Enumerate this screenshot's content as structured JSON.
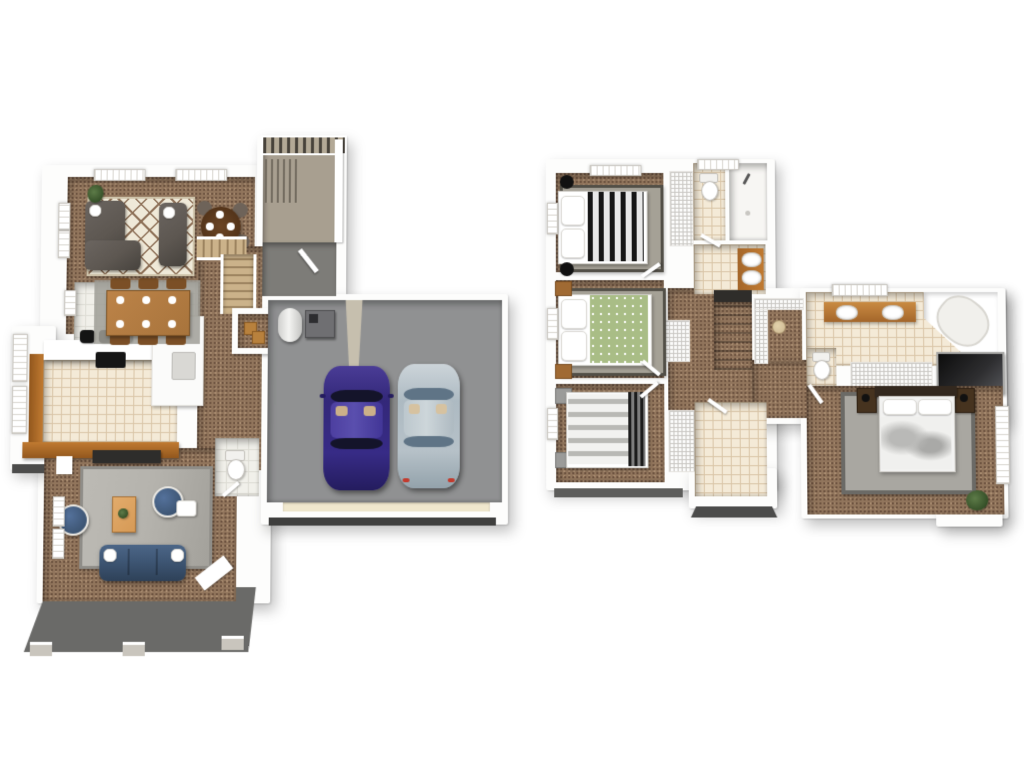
{
  "scene": {
    "type": "3d-floor-plan-rendering",
    "description": "Top-down 3D dollhouse floor plan of a two-story home, first floor on the left and second floor on the right, white background, no text labels",
    "levels_count": 2
  },
  "palette": {
    "wall": "#fdfdfc",
    "wall-shade": "#d7d4cf",
    "carpet-base": "#91755c",
    "carpet-dark": "#6d5340",
    "carpet-light": "#a98c70",
    "tile-cream": "#f4ead7",
    "tile-cream-line": "#d9c5a7",
    "tile-white": "#f1f0ea",
    "tile-white-line": "#dddcd4",
    "garage-floor": "#909192",
    "patio": "#6a6a68",
    "porch": "#7d7c78",
    "deck": "#a89f90",
    "deck-slat": "#47423a",
    "rug-cream": "#efe9d8",
    "rug-lattice": "#8d7057",
    "rug-gray": "#b5b3ad",
    "rug-gray-border": "#8f8d88",
    "rug-stone": "#a5a196",
    "rug-stone-border": "#524f47",
    "sofa-gray": "#5d5751",
    "navy": "#3e5674",
    "wood": "#c07a31",
    "wood-light": "#d69a56",
    "table-wood": "#a8743c",
    "stair-wood": "#cbb28a",
    "car-purple": "#372b86",
    "car-silver": "#b6c1c8",
    "bed-green": "#a9bd86",
    "headboard-dark": "#33281e",
    "hatch-line": "#c9c7c3",
    "under-slab": "#4c4c4b",
    "glass-black": "#161616",
    "metal-gray": "#6f6f72",
    "plant-green": "#3c5a2e"
  },
  "levels": [
    {
      "id": "first-floor",
      "position": "left",
      "rooms": [
        {
          "name": "living-room",
          "floor": "carpet",
          "furniture": [
            "sectional-sofa",
            "loveseat",
            "diamond-area-rug",
            "round-breakfast-table",
            "four-chairs",
            "house-plant"
          ]
        },
        {
          "name": "dining-area",
          "floor": "white-tile",
          "furniture": [
            "wood-dining-table",
            "six-place-settings",
            "dining-chairs",
            "floor-mat"
          ]
        },
        {
          "name": "kitchen",
          "floor": "cream-tile",
          "furniture": [
            "wood-base-cabinets",
            "white-counter",
            "black-cooktop",
            "three-black-bar-stools",
            "refrigerator-counter-run"
          ]
        },
        {
          "name": "staircase",
          "floor": "wood-treads",
          "furniture": []
        },
        {
          "name": "storage-closet",
          "floor": "carpet",
          "furniture": [
            "wooden-crates"
          ]
        },
        {
          "name": "powder-room",
          "floor": "white-tile",
          "furniture": [
            "toilet"
          ]
        },
        {
          "name": "entry-porch",
          "floor": "gray-concrete",
          "furniture": [
            "entry-door"
          ]
        },
        {
          "name": "deck",
          "floor": "tan-composite",
          "furniture": [
            "pergola-slats",
            "railing"
          ]
        },
        {
          "name": "family-room",
          "floor": "carpet",
          "furniture": [
            "navy-sofa",
            "two-round-navy-chairs",
            "gray-area-rug",
            "wood-coffee-table",
            "tv-console",
            "side-table"
          ]
        },
        {
          "name": "garage",
          "floor": "gray-concrete",
          "furniture": [
            "purple-sedan",
            "silver-sedan",
            "water-heater",
            "furnace-unit",
            "garage-door"
          ]
        },
        {
          "name": "rear-patio",
          "floor": "dark-concrete",
          "furniture": [
            "footings"
          ]
        }
      ]
    },
    {
      "id": "second-floor",
      "position": "right",
      "rooms": [
        {
          "name": "bedroom-1",
          "floor": "carpet",
          "furniture": [
            "bed-black-white-striped",
            "stone-rug",
            "two-black-nightstands"
          ]
        },
        {
          "name": "bedroom-1-closet",
          "floor": "wire-shelving",
          "furniture": []
        },
        {
          "name": "hall-bathroom",
          "floor": "cream-tile",
          "furniture": [
            "toilet",
            "walk-in-shower",
            "wood-vanity-double-sink"
          ]
        },
        {
          "name": "bedroom-2",
          "floor": "carpet",
          "furniture": [
            "bed-green-pattern",
            "stone-rug",
            "two-wood-nightstands"
          ]
        },
        {
          "name": "linen-closet",
          "floor": "wire-shelving",
          "furniture": []
        },
        {
          "name": "hallway",
          "floor": "carpet",
          "furniture": []
        },
        {
          "name": "staircase",
          "floor": "carpet-treads",
          "furniture": []
        },
        {
          "name": "bedroom-3",
          "floor": "carpet",
          "furniture": [
            "bed-gray-striped",
            "slat-headboard",
            "two-gray-nightstands"
          ]
        },
        {
          "name": "bedroom-3-closet",
          "floor": "wire-shelving",
          "furniture": []
        },
        {
          "name": "laundry-room",
          "floor": "cream-tile",
          "furniture": []
        },
        {
          "name": "walk-in-closet",
          "floor": "carpet",
          "furniture": [
            "wire-shelves",
            "hamper"
          ]
        },
        {
          "name": "master-bathroom",
          "floor": "cream-tile",
          "furniture": [
            "wood-vanity-double-sink",
            "corner-tub",
            "black-glass-shower",
            "toilet"
          ]
        },
        {
          "name": "master-closet",
          "floor": "wire-shelving",
          "furniture": []
        },
        {
          "name": "master-bedroom",
          "floor": "carpet",
          "furniture": [
            "bed-white-gray",
            "dark-headboard",
            "two-dark-nightstands",
            "gray-area-rug",
            "house-plant"
          ]
        }
      ]
    }
  ]
}
